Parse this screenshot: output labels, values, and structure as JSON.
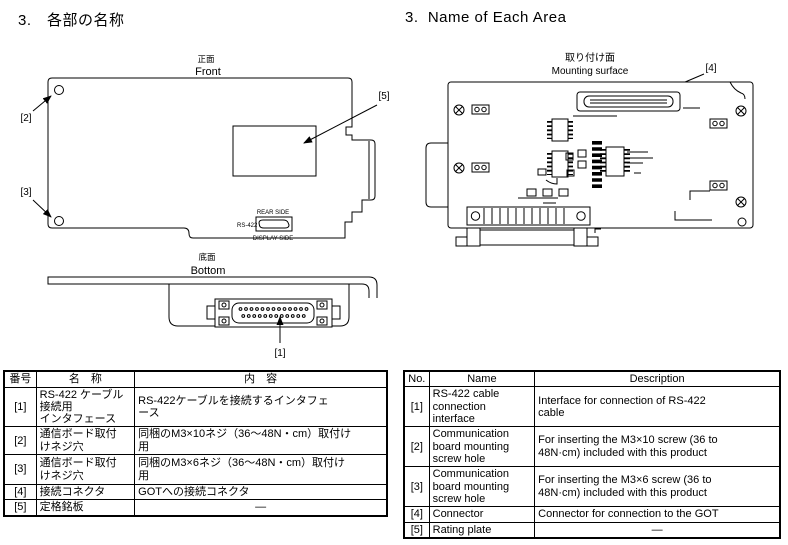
{
  "page": {
    "heading_jp": "3.　各部の名称",
    "heading_en": "3.  Name of Each Area"
  },
  "diagrams": {
    "front": {
      "title_jp": "正面",
      "title_en": "Front",
      "label_2": "[2]",
      "label_3": "[3]",
      "label_5": "[5]",
      "rear_side": "REAR SIDE",
      "rs422": "RS-422",
      "display_side": "DISPLAY SIDE"
    },
    "bottom": {
      "title_jp": "底面",
      "title_en": "Bottom",
      "label_1": "[1]"
    },
    "mounting": {
      "title_jp": "取り付け面",
      "title_en": "Mounting surface",
      "label_4": "[4]"
    }
  },
  "table_jp": {
    "headers": [
      "番号",
      "名　称",
      "内　容"
    ],
    "rows": [
      {
        "no": "[1]",
        "name": "RS-422 ケーブル\n接続用\nインタフェース",
        "desc": "RS-422ケーブルを接続するインタフェ\nース"
      },
      {
        "no": "[2]",
        "name": "通信ボード取付\nけネジ穴",
        "desc": "同梱のM3×10ネジ（36～48N・cm）取付け\n用"
      },
      {
        "no": "[3]",
        "name": "通信ボード取付\nけネジ穴",
        "desc": "同梱のM3×6ネジ（36～48N・cm）取付け\n用"
      },
      {
        "no": "[4]",
        "name": "接続コネクタ",
        "desc": "GOTへの接続コネクタ"
      },
      {
        "no": "[5]",
        "name": "定格銘板",
        "desc": "―"
      }
    ]
  },
  "table_en": {
    "headers": [
      "No.",
      "Name",
      "Description"
    ],
    "rows": [
      {
        "no": "[1]",
        "name": "RS-422 cable\nconnection\ninterface",
        "desc": "Interface for connection of RS-422\ncable"
      },
      {
        "no": "[2]",
        "name": "Communication\nboard mounting\nscrew  hole",
        "desc": "For inserting the M3×10 screw (36 to\n48N·cm) included with this product"
      },
      {
        "no": "[3]",
        "name": "Communication\nboard mounting\nscrew  hole",
        "desc": "For inserting the M3×6 screw (36 to\n48N·cm) included with this product"
      },
      {
        "no": "[4]",
        "name": "Connector",
        "desc": "Connector for connection to the GOT"
      },
      {
        "no": "[5]",
        "name": "Rating plate",
        "desc": "—"
      }
    ]
  }
}
